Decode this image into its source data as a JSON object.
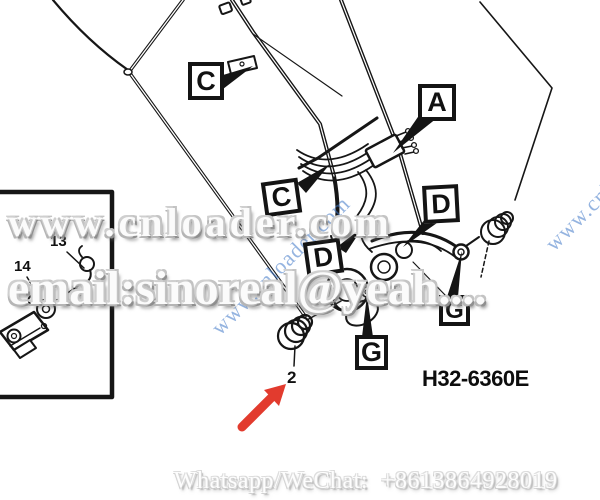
{
  "watermarks": {
    "row1": "www.cnloader.com",
    "row2": "email:sinoreal@yeah....",
    "diagonal": "www.cnloader.com",
    "diagonal_right": "www.cnloader.com",
    "bottom": "Whatsapp/WeChat:  +8613864928019"
  },
  "diagram": {
    "part_number": "H32-6360E",
    "callouts": [
      {
        "id": "C1",
        "label": "C"
      },
      {
        "id": "A",
        "label": "A"
      },
      {
        "id": "C2",
        "label": "C"
      },
      {
        "id": "D1",
        "label": "D"
      },
      {
        "id": "D2",
        "label": "D"
      },
      {
        "id": "G1",
        "label": "G"
      },
      {
        "id": "G2",
        "label": "G"
      }
    ],
    "items": {
      "inset_top": "13",
      "inset_bottom": "14",
      "pointed": "2"
    }
  },
  "colors": {
    "arrow_red": "#e23b2e",
    "watermark_blue": "#3f79c9",
    "line": "#161616"
  }
}
